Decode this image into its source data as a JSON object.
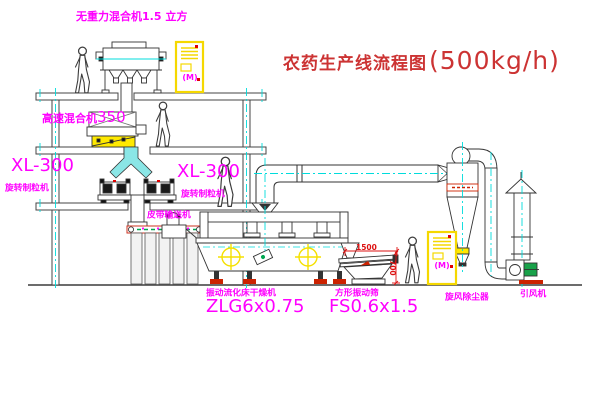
{
  "title": {
    "text": "农药生产线流程图",
    "capacity": "(500kg/h)"
  },
  "labels": {
    "gravity_mixer": "无重力混合机1.5 立方",
    "high_speed_mixer_name": "高速混合机",
    "high_speed_mixer_size": "350",
    "granulator_model": "XL-300",
    "granulator_name": "旋转制粒机",
    "granulator_model_2": "XL-300",
    "granulator_name_2": "旋转制粒机",
    "belt_conveyor": "皮带输送机",
    "dryer_name": "振动流化床干燥机",
    "dryer_model": "ZLG6x0.75",
    "screen_name": "方形振动筛",
    "screen_model": "FS0.6x1.5",
    "cyclone": "旋风除尘器",
    "fan": "引风机"
  },
  "dimensions": {
    "width": "1500",
    "height": "700"
  },
  "cabinets": {
    "glyph1": "(M)",
    "glyph2": "(M)"
  },
  "colors": {
    "label_magenta": "#ff00ff",
    "title_red": "#cc3333",
    "dimension_red": "#dd1111",
    "line_dark": "#3c3c3c",
    "centerline_cyan": "#00dcdc",
    "highlight_yellow": "#f5e000",
    "chute_cyan": "#8ae6e6",
    "motor_green": "#19a24a",
    "base_red": "#cc2200"
  }
}
